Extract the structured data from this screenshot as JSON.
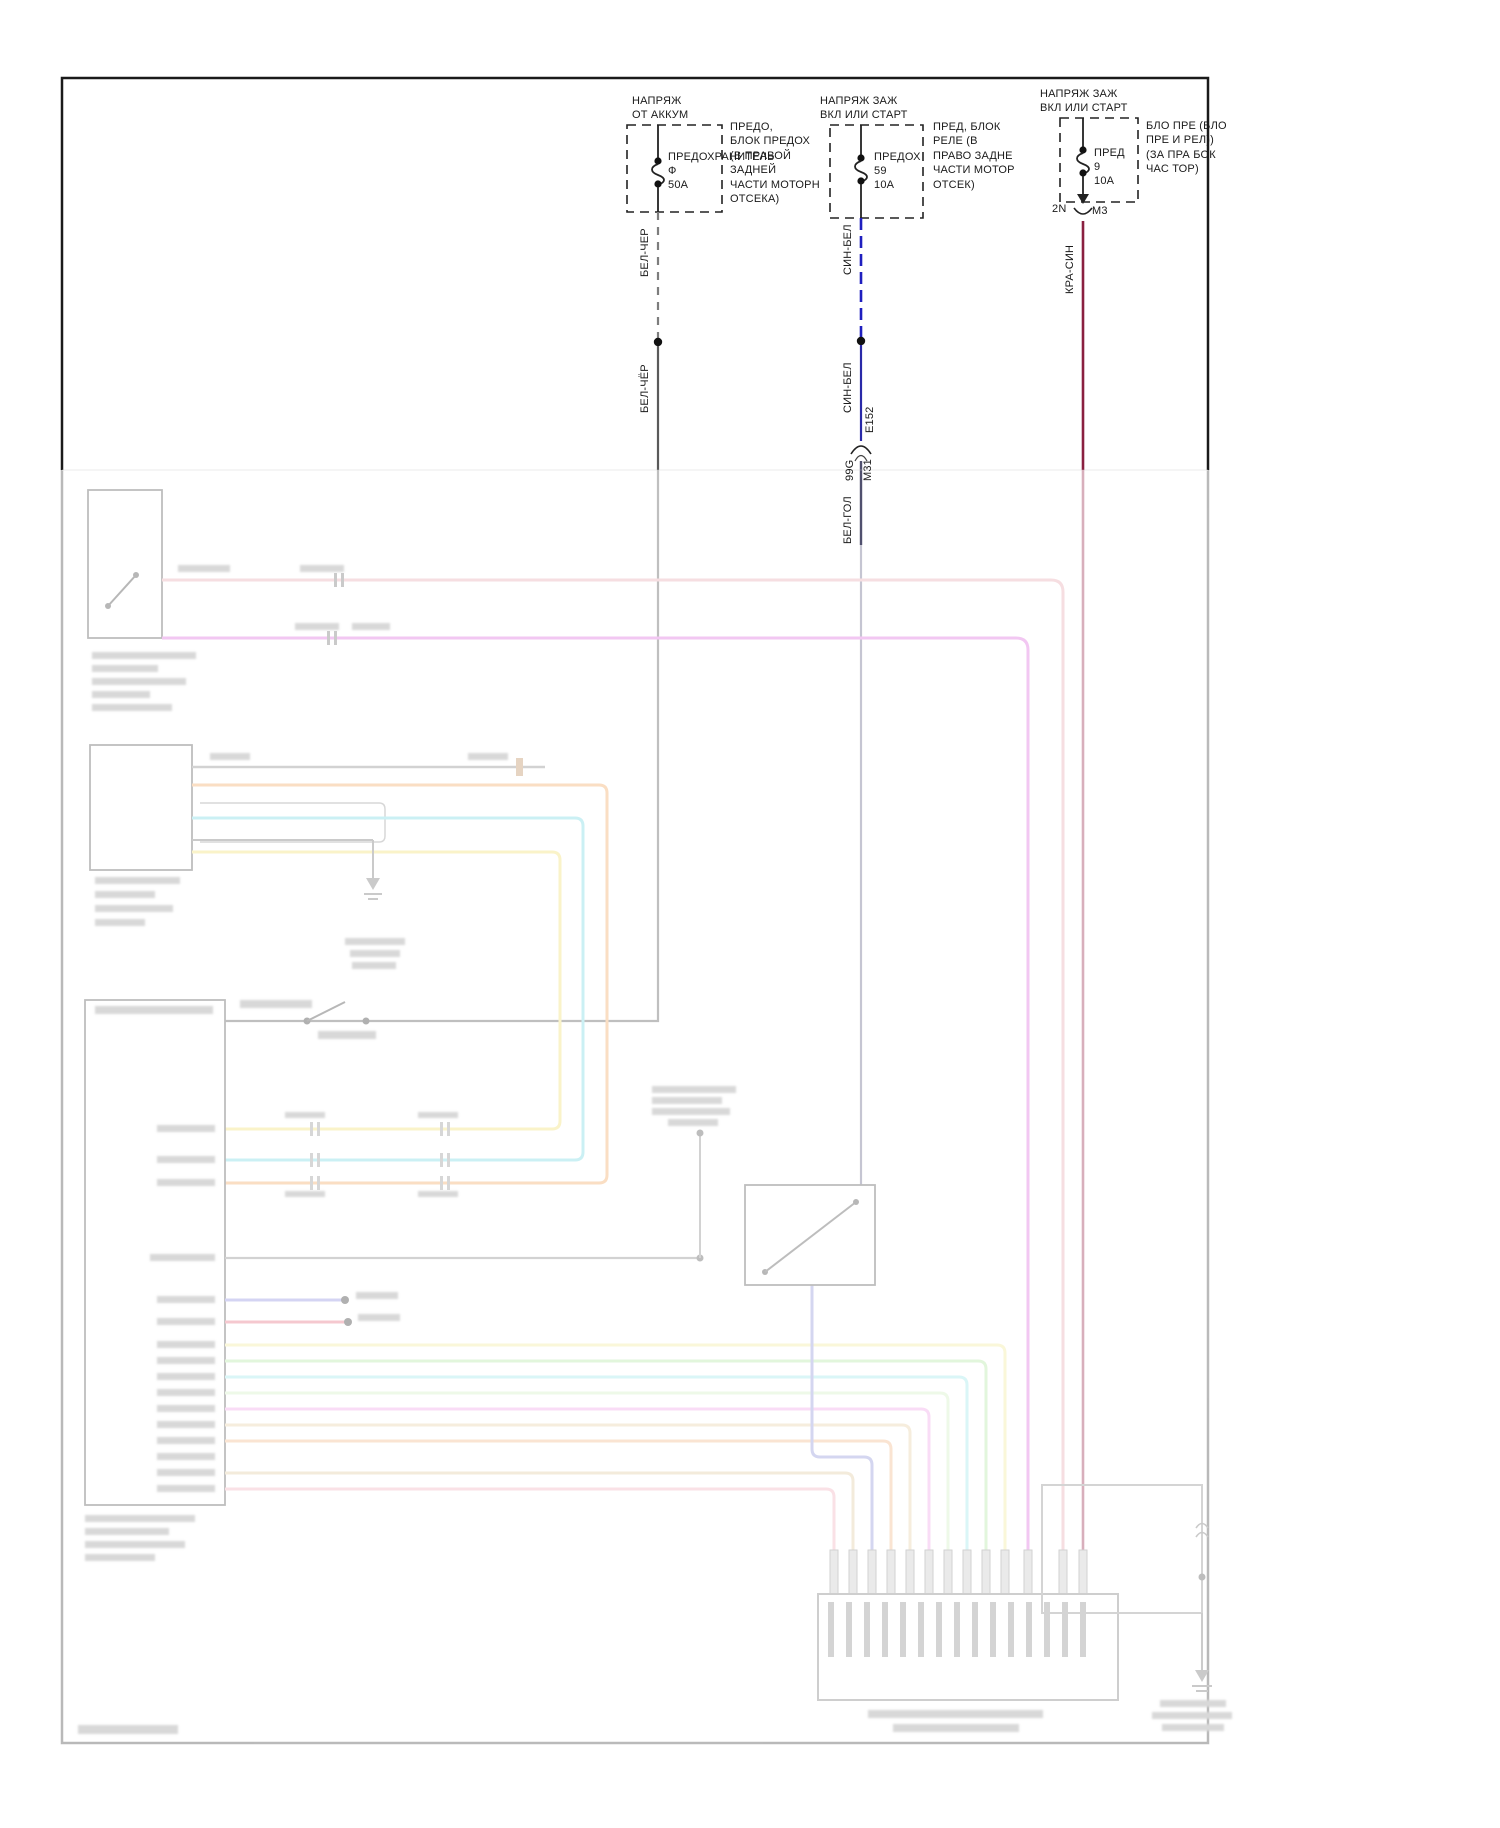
{
  "power_feeds": [
    {
      "id": "battery-feed",
      "title_lines": [
        "НАПРЯЖ",
        "ОТ АККУМ"
      ],
      "fuse": {
        "label": "ПРЕДОХРАНИТЕЛЬ",
        "id": "Ф",
        "rating": "50A"
      },
      "location_lines": [
        "ПРЕДО,",
        "БЛОК ПРЕДОХ",
        "(В ПРАВОЙ",
        "ЗАДНЕЙ",
        "ЧАСТИ МОТОРН",
        "ОТСЕКА)"
      ],
      "wire_top_label": "БЕЛ-ЧЕР",
      "wire_bottom_label": "БЕЛ-ЧЁР",
      "wire_color": "#5a5a5a"
    },
    {
      "id": "ignition-feed-1",
      "title_lines": [
        "НАПРЯЖ ЗАЖ",
        "ВКЛ ИЛИ СТАРТ"
      ],
      "fuse": {
        "label": "ПРЕДОХ",
        "id": "59",
        "rating": "10A"
      },
      "location_lines": [
        "ПРЕД, БЛОК",
        "РЕЛЕ (В",
        "ПРАВО ЗАДНЕ",
        "ЧАСТИ МОТОР",
        "ОТСЕК)"
      ],
      "wire_top_label": "СИН-БЕЛ",
      "wire_bottom_label": "СИН-БЕЛ",
      "splice_label": "E152",
      "connector": {
        "left_label": "99G",
        "right_label": "M31"
      },
      "wire_below_connector_label": "БЕЛ-ГОЛ",
      "wire_color": "#2929a8"
    },
    {
      "id": "ignition-feed-2",
      "title_lines": [
        "НАПРЯЖ ЗАЖ",
        "ВКЛ ИЛИ СТАРТ"
      ],
      "fuse": {
        "label": "ПРЕД",
        "id": "9",
        "rating": "10A"
      },
      "location_lines": [
        "БЛО ПРЕ (БЛО",
        "ПРЕ И РЕЛ))",
        "(ЗА ПРА БОК",
        "ЧАС ТОР)"
      ],
      "connector": {
        "left_label": "2N",
        "right_label": "M3"
      },
      "wire_top_label": "КРА-СИН",
      "wire_color": "#8a2040"
    }
  ],
  "faded_section": {
    "opacity": 0.38,
    "wire_palette": {
      "pink": "#eaaab2",
      "magenta": "#df6fdf",
      "orange": "#f2a963",
      "cyan": "#79d9e3",
      "yellow": "#f2e272",
      "gray": "#8a8a8a",
      "violet_stub": "#8f8fe0",
      "crimson_stub": "#e57083",
      "pale_yellow": "#f2ec9e",
      "green": "#b5e8a5",
      "pale_green": "#d5f0c5",
      "tan": "#e8d0a8",
      "blue": "#9095d8",
      "rose": "#f2b3bf",
      "maroon_faded": "#9a3050"
    }
  }
}
